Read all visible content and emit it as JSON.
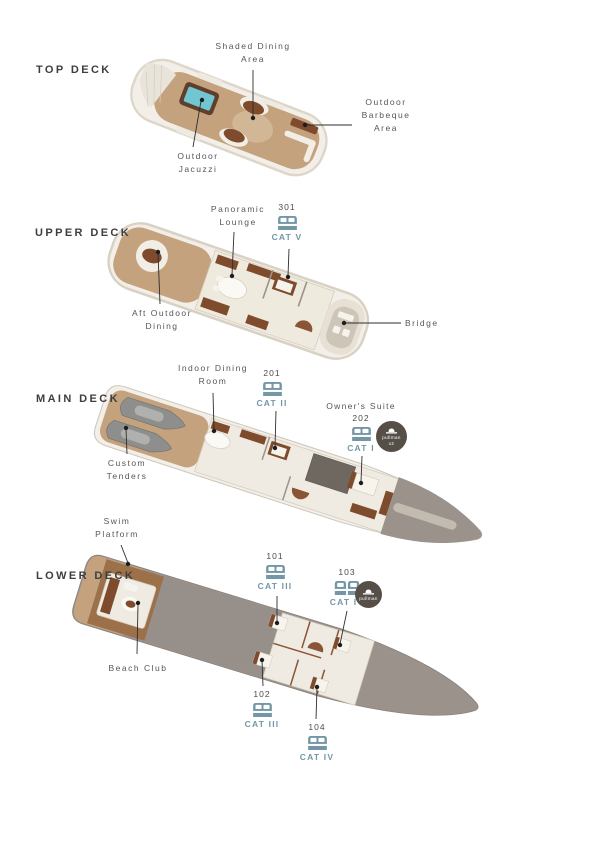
{
  "colors": {
    "category_accent": "#7397a7",
    "callout_text": "#55565a",
    "deck_title_text": "#3e3e40",
    "pullman_badge": "#564f48",
    "deck_wood": "#c3a27d",
    "hull_gray": "#9a928b",
    "furniture_brown": "#7e4b2c",
    "jacuzzi_teal": "#72c6d1"
  },
  "decks": [
    {
      "title": "TOP DECK",
      "callouts": [
        {
          "label": "Shaded Dining\nArea"
        },
        {
          "label": "Outdoor\nBarbeque\nArea"
        },
        {
          "label": "Outdoor\nJacuzzi"
        }
      ]
    },
    {
      "title": "UPPER DECK",
      "callouts": [
        {
          "label": "Panoramic\nLounge"
        },
        {
          "label": "Aft Outdoor\nDining"
        },
        {
          "label": "Bridge"
        }
      ],
      "cabins": [
        {
          "number": "301",
          "category": "CAT V",
          "bed": "double"
        }
      ]
    },
    {
      "title": "MAIN DECK",
      "callouts": [
        {
          "label": "Indoor Dining\nRoom"
        },
        {
          "label": "Custom\nTenders"
        }
      ],
      "cabins": [
        {
          "number": "201",
          "category": "CAT II",
          "bed": "double"
        },
        {
          "suite": "Owner's Suite",
          "number": "202",
          "category": "CAT I",
          "bed": "double",
          "pullman": "pullman",
          "pullman_qty": "x2"
        }
      ]
    },
    {
      "title": "LOWER DECK",
      "callouts": [
        {
          "label": "Swim\nPlatform"
        },
        {
          "label": "Beach Club"
        }
      ],
      "cabins": [
        {
          "number": "101",
          "category": "CAT III",
          "bed": "double"
        },
        {
          "number": "103",
          "category": "CAT IV",
          "bed": "twin",
          "pullman": "pullman"
        },
        {
          "number": "102",
          "category": "CAT III",
          "bed": "double"
        },
        {
          "number": "104",
          "category": "CAT IV",
          "bed": "double"
        }
      ]
    }
  ]
}
